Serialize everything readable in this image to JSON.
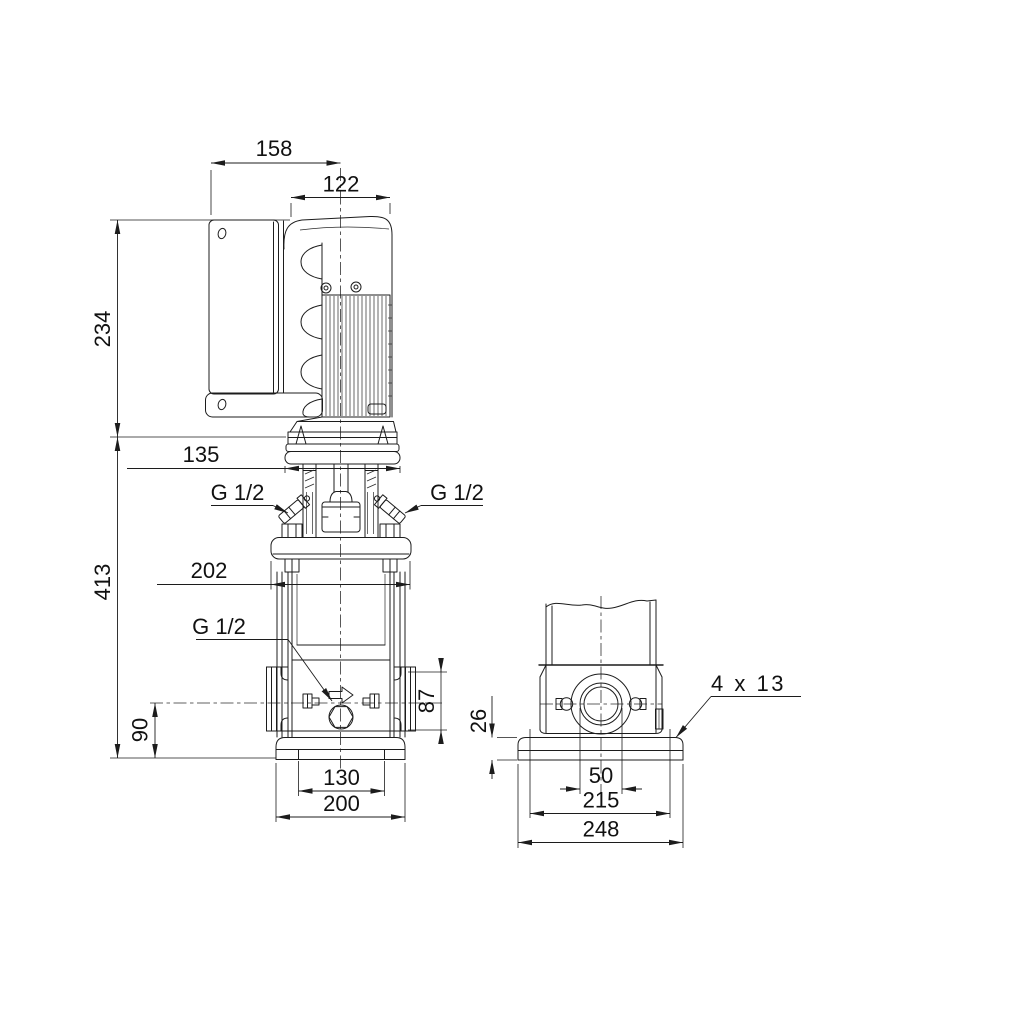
{
  "page": {
    "background": "#ffffff",
    "line_color": "#1c1c1c"
  },
  "front_view": {
    "title": "pump front elevation",
    "dims": {
      "overall_width": "158",
      "motor_width": "122",
      "motor_height": "234",
      "adapter_width": "135",
      "pump_height": "413",
      "head_flange_width": "202",
      "port_center_height": "90",
      "port_flange_height": "87",
      "base_slot_spacing": "130",
      "base_width": "200"
    },
    "labels": {
      "vent_port_left": "G 1/2",
      "vent_port_right": "G 1/2",
      "drain_port": "G 1/2"
    }
  },
  "side_view": {
    "title": "pump base side view",
    "dims": {
      "base_plate_height": "26",
      "port_bore": "50",
      "bolt_hole_spacing": "215",
      "base_width": "248"
    },
    "labels": {
      "bolt_holes": "4 x 13"
    }
  }
}
